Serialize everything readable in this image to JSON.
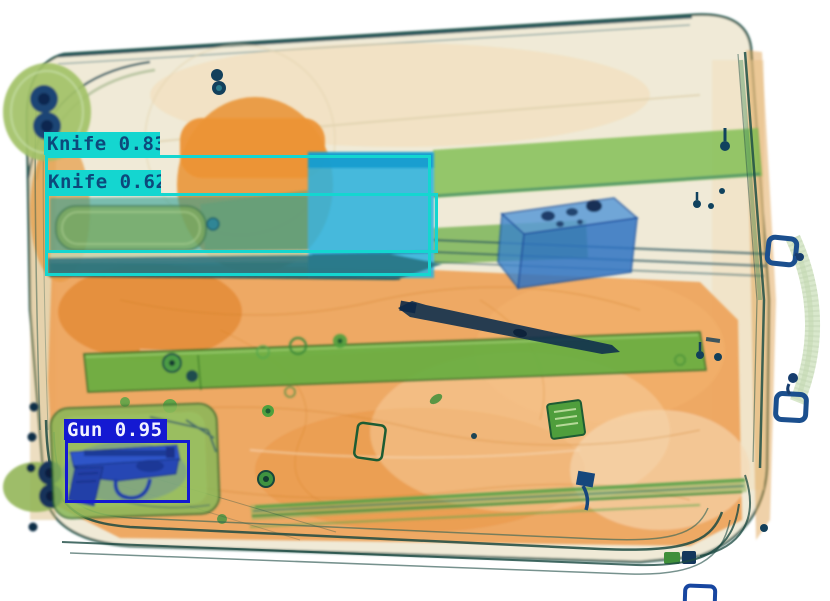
{
  "window": {
    "width_px": 830,
    "height_px": 601,
    "background": "#ffffff",
    "description": "X-ray baggage scan of a suitcase with object-detection overlay boxes"
  },
  "detections": [
    {
      "display": "Knife 0.83",
      "label": "Knife",
      "confidence": 0.83,
      "box_color": "#14d6d0",
      "label_bg": "#14d6d0",
      "text_color": "#0d497b",
      "box": {
        "x": 45,
        "y": 155,
        "w": 386,
        "h": 121
      },
      "label_pos": {
        "x": 44,
        "y": 132,
        "w": 116,
        "h": 23
      }
    },
    {
      "display": "Knife 0.62",
      "label": "Knife",
      "confidence": 0.62,
      "box_color": "#14d6d0",
      "label_bg": "#14d6d0",
      "text_color": "#0d497b",
      "box": {
        "x": 46,
        "y": 193,
        "w": 392,
        "h": 60
      },
      "label_pos": {
        "x": 45,
        "y": 170,
        "w": 116,
        "h": 23
      }
    },
    {
      "display": "Gun 0.95",
      "label": "Gun",
      "confidence": 0.95,
      "box_color": "#1419d2",
      "label_bg": "#1419d2",
      "text_color": "#f2f2ff",
      "box": {
        "x": 65,
        "y": 440,
        "w": 125,
        "h": 63
      },
      "label_pos": {
        "x": 64,
        "y": 419,
        "w": 103,
        "h": 21
      }
    }
  ],
  "scene": {
    "objects_visible": [
      "suitcase",
      "knife",
      "pistol",
      "pen",
      "blue metal box",
      "wheels",
      "trolley rails",
      "side handle",
      "straps"
    ],
    "palette": {
      "shell_cream": "#f0ead7",
      "shell_outline": "#24564c",
      "organic_orange": "#eea35a",
      "organic_dark": "#e28a33",
      "strap_green": "#7dbd4f",
      "bar_green": "#68ae3f",
      "knife_blade_cyan": "#2cb2dd",
      "knife_body_teal": "#2f9c92",
      "metal_box_blue": "#2e7ac6",
      "gun_blue": "#2f55c8",
      "wheel_navy": "#1d4474"
    }
  }
}
